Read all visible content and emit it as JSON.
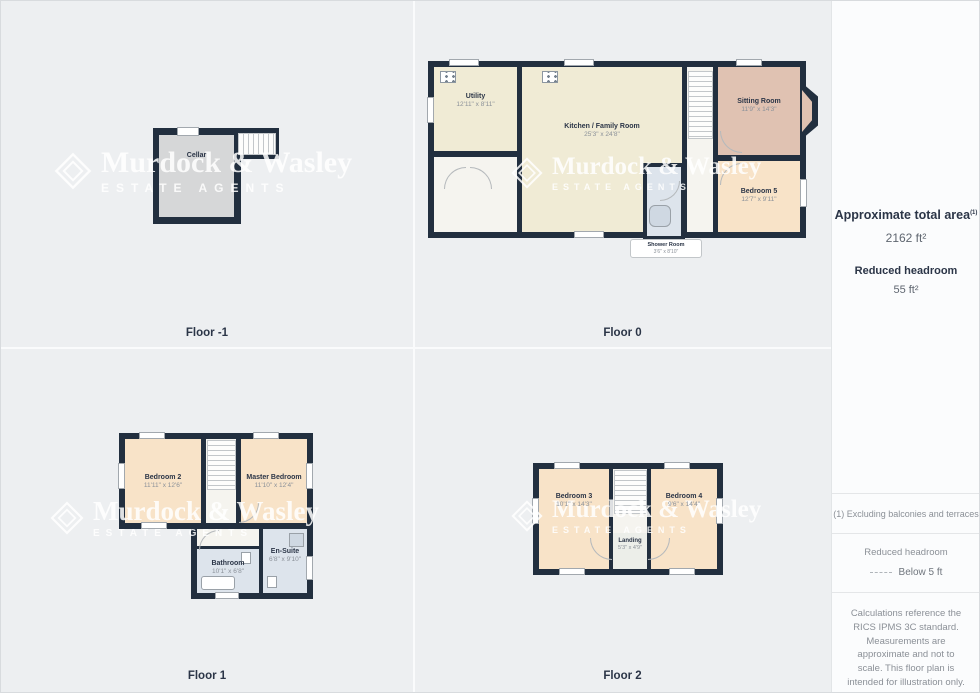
{
  "watermark": {
    "name": "Murdock & Wasley",
    "sub": "ESTATE AGENTS"
  },
  "floors": {
    "minus1": {
      "label": "Floor -1",
      "cellar": {
        "name": "Cellar",
        "dims": ""
      }
    },
    "f0": {
      "label": "Floor 0",
      "utility": {
        "name": "Utility",
        "dims": "12'11\" x 8'11\""
      },
      "kitchen": {
        "name": "Kitchen / Family Room",
        "dims": "25'3\" x 24'8\""
      },
      "sitting": {
        "name": "Sitting Room",
        "dims": "11'9\" x 14'3\""
      },
      "bedroom5": {
        "name": "Bedroom 5",
        "dims": "12'7\" x 9'11\""
      },
      "shower": {
        "name": "Shower Room",
        "dims": "3'6\" x 8'10\""
      }
    },
    "f1": {
      "label": "Floor 1",
      "bedroom2": {
        "name": "Bedroom 2",
        "dims": "11'11\" x 12'6\""
      },
      "master": {
        "name": "Master Bedroom",
        "dims": "11'10\" x 12'4\""
      },
      "bathroom": {
        "name": "Bathroom",
        "dims": "10'1\" x 6'8\""
      },
      "ensuite": {
        "name": "En-Suite",
        "dims": "6'8\" x 9'10\""
      }
    },
    "f2": {
      "label": "Floor 2",
      "bedroom3": {
        "name": "Bedroom 3",
        "dims": "10'1\" x 14'3\""
      },
      "bedroom4": {
        "name": "Bedroom 4",
        "dims": "9'6\" x 14'4\""
      },
      "landing": {
        "name": "Landing",
        "dims": "5'3\" x 4'9\""
      }
    }
  },
  "sidebar": {
    "total_area_label": "Approximate total area",
    "total_area_footnote_marker": "(1)",
    "total_area_value": "2162 ft²",
    "headroom_label": "Reduced headroom",
    "headroom_value": "55 ft²",
    "footnote": "(1) Excluding balconies and terraces",
    "legend_title": "Reduced headroom",
    "legend_item": "Below 5 ft",
    "disclaimer": "Calculations reference the RICS IPMS 3C standard. Measurements are approximate and not to scale. This floor plan is intended for illustration only.",
    "brand_primary": "GIRAFFE",
    "brand_secondary": "360"
  },
  "colors": {
    "wall": "#222f3f",
    "room_cream": "#f0ebd5",
    "room_peach": "#f8e3c8",
    "room_rose": "#e0c2b2",
    "room_bath": "#dde4ec",
    "room_cellar": "#d6d7d8",
    "text_dark": "#2b3547",
    "text_dim": "#8b9199"
  }
}
